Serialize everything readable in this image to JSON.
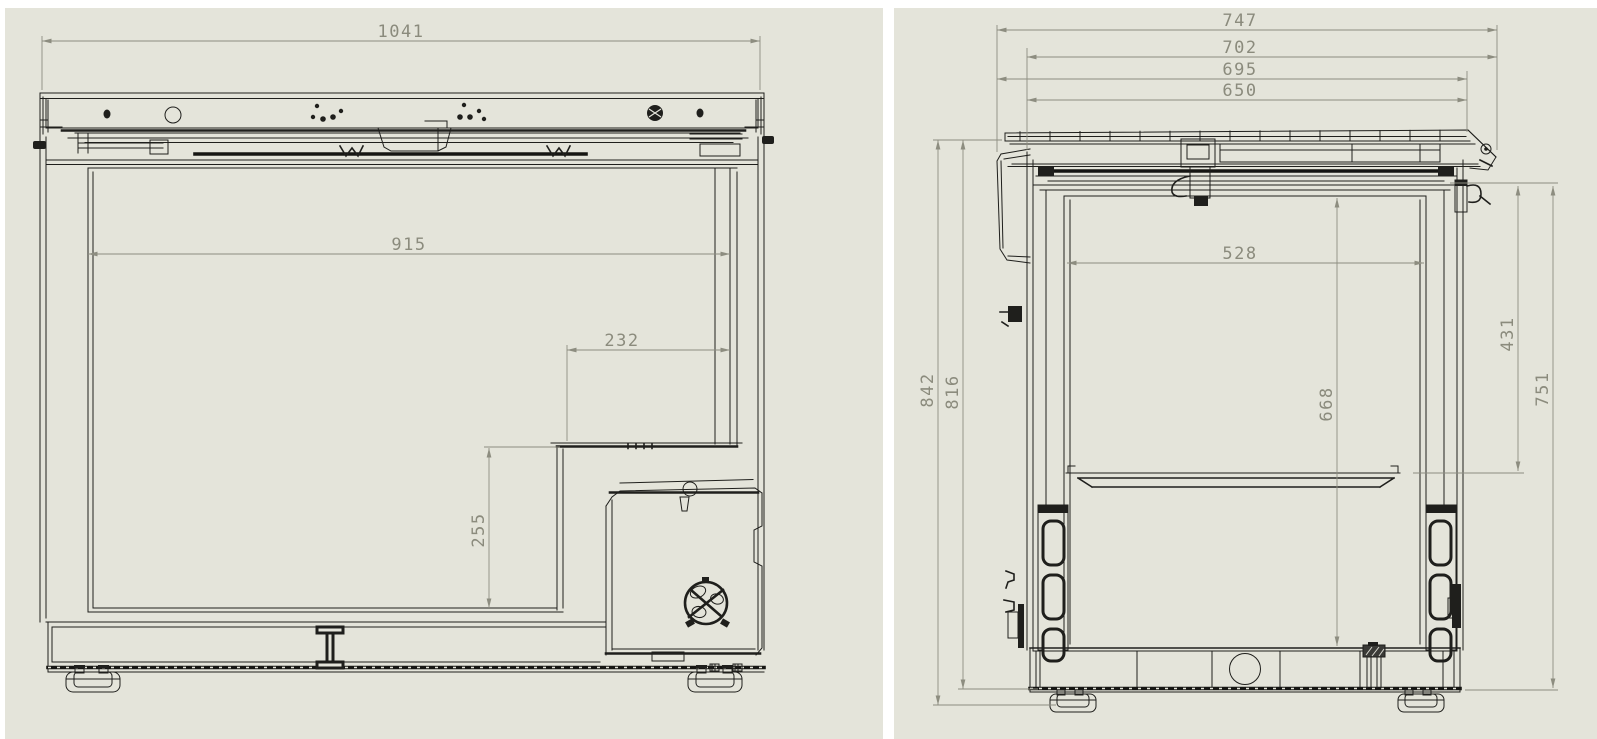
{
  "colors": {
    "page_background": "#ffffff",
    "sheet_background": "#e4e4da",
    "part_line": "#1f1f1c",
    "dimension_line": "#8d8d80",
    "dimension_text": "#8b8b7d"
  },
  "views": {
    "side": {
      "dims": {
        "overall_width": "1041",
        "liner_width": "915",
        "step_width": "232",
        "step_height": "255"
      }
    },
    "front": {
      "dims": {
        "lid_overall": "747",
        "overall_with_hinge": "702",
        "lid_width": "695",
        "cabinet_width": "650",
        "liner_width": "528",
        "liner_depth": "668",
        "hinge_to_tray": "431",
        "hinge_to_base": "751",
        "overall_height": "842",
        "body_height": "816"
      }
    }
  }
}
